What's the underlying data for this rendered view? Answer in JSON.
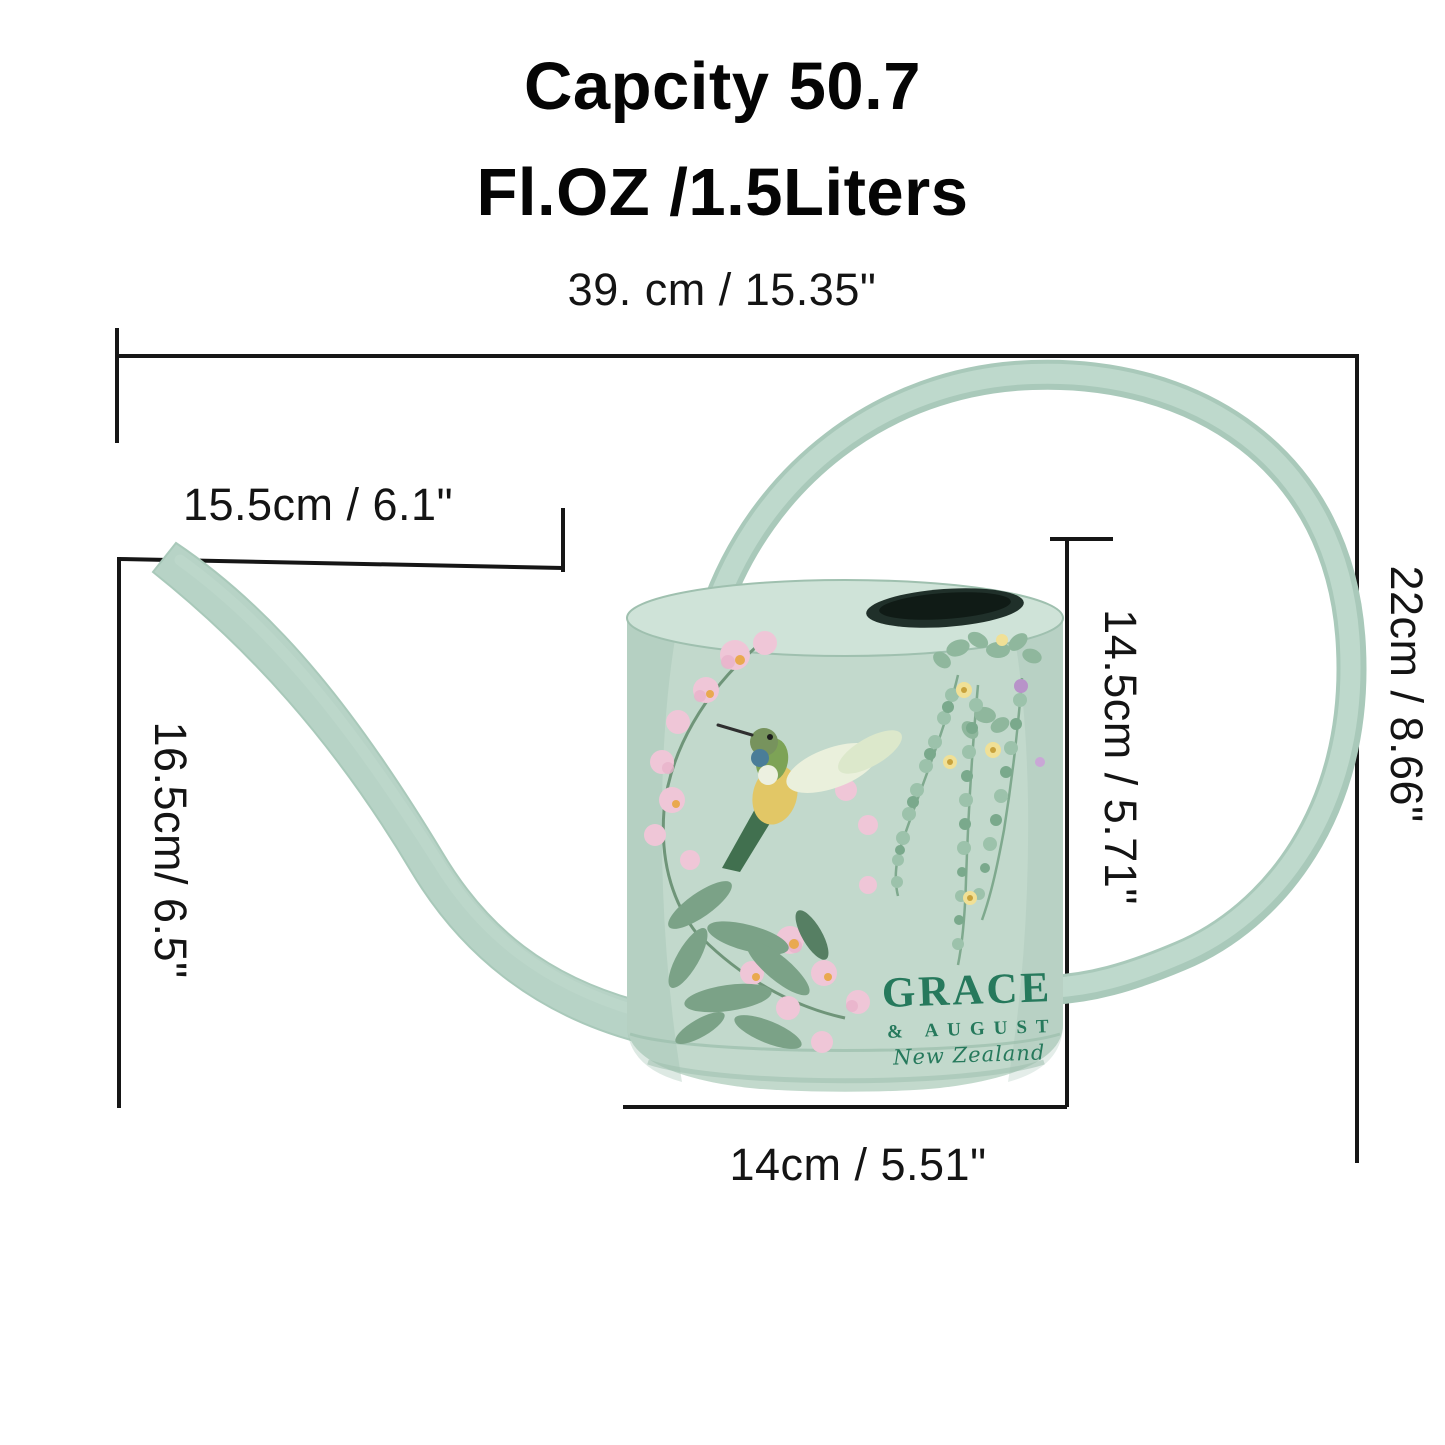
{
  "title": {
    "line1": "Capcity 50.7",
    "line2": "Fl.OZ /1.5Liters"
  },
  "measurements": {
    "top_width": "39. cm / 15.35\"",
    "spout_length": "15.5cm / 6.1\"",
    "spout_height": "16.5cm/ 6.5\"",
    "can_height": "14.5cm / 5.71\"",
    "overall_height": "22cm / 8.66\"",
    "base_width": "14cm / 5.51\""
  },
  "brand": {
    "primary": "GRACE",
    "secondary": "& AUGUST",
    "origin": "New Zealand"
  },
  "colors": {
    "line": "#161616",
    "text": "#141414",
    "can_body": "#c2d9cc",
    "can_top": "#cfe3d8",
    "can_edge": "#9fc0af",
    "tube_outer": "#a9c9ba",
    "tube_inner": "#bed9cc",
    "spout": "#b7d3c6",
    "opening": "#20302a",
    "logo_green": "#26795c",
    "flower_pink": "#efc6d7",
    "flower_yellow": "#ecd167",
    "leaf_green": "#7ba287",
    "bead_green": "#9cc2ab",
    "bird_blue": "#4a7d98",
    "bird_yellow": "#e2c766"
  }
}
